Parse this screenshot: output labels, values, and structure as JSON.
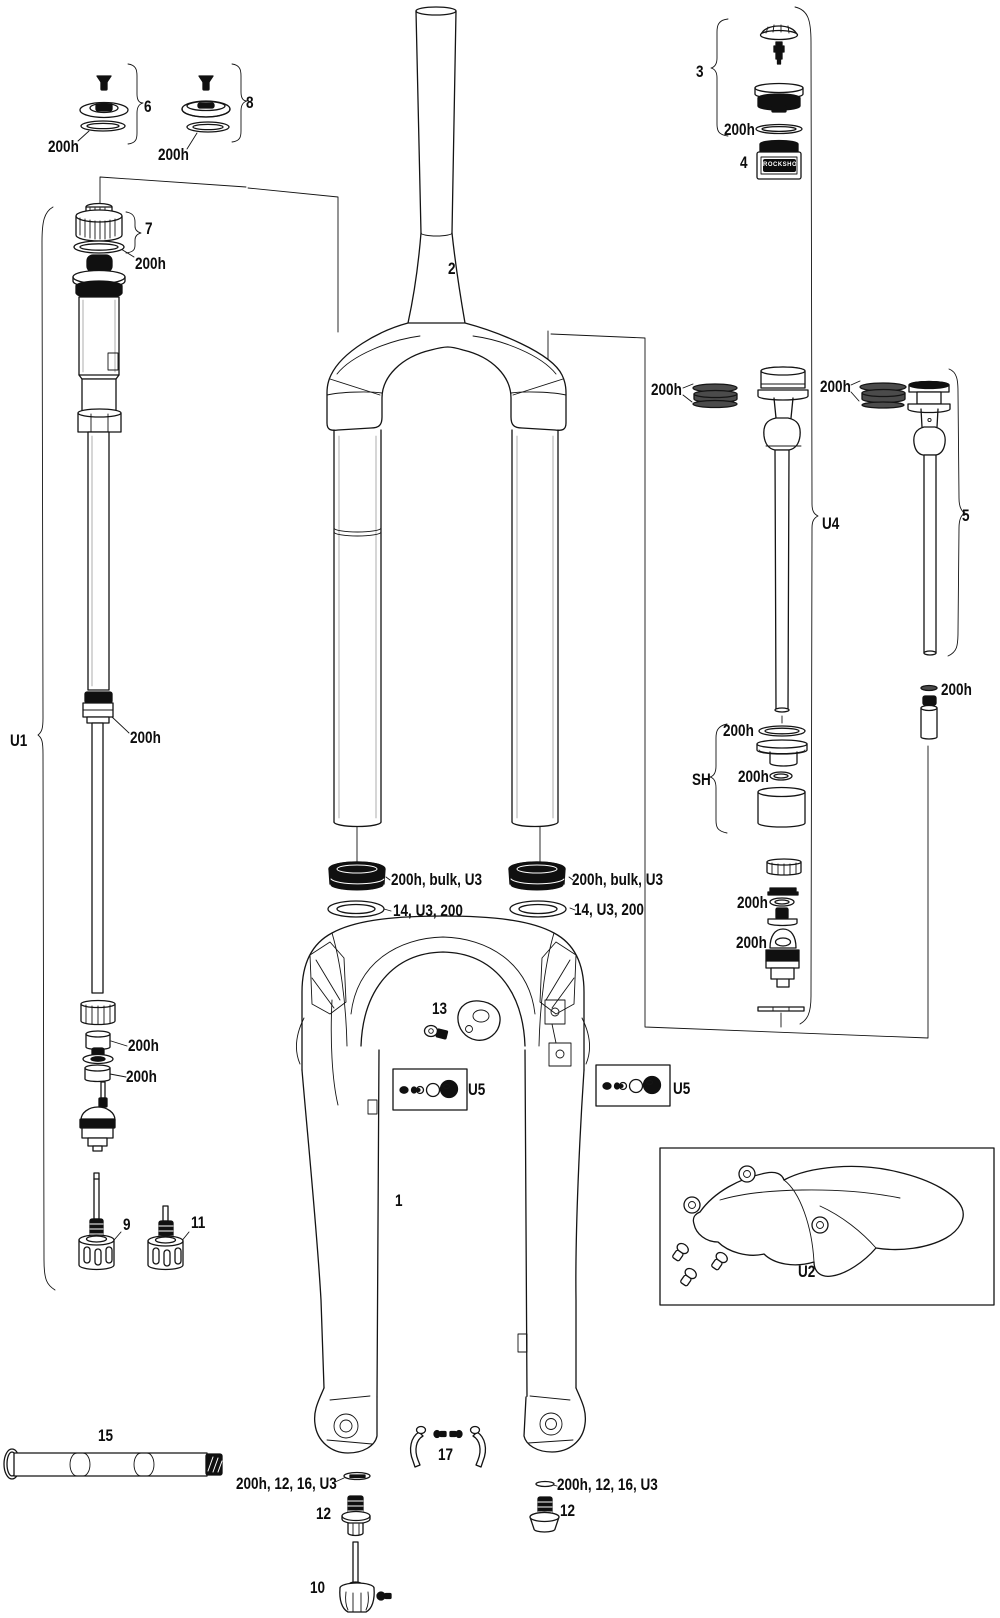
{
  "page": {
    "background": "#ffffff",
    "ink": "#141414"
  },
  "callouts": {
    "c1": "1",
    "c2": "2",
    "c3": "3",
    "c4": "4",
    "c5": "5",
    "c6": "6",
    "c7": "7",
    "c8": "8",
    "c9": "9",
    "c10": "10",
    "c11": "11",
    "c12": "12",
    "c13": "13",
    "c15": "15",
    "c17": "17",
    "u1": "U1",
    "u2": "U2",
    "u4": "U4",
    "u5": "U5",
    "sh": "SH",
    "service": "200h",
    "dust_seal_kit": "200h, bulk, U3",
    "foam_ring": "14, U3, 200",
    "shaft_bolt_seal": "200h, 12, 16, U3",
    "tub_label": "ROCKSHOX"
  }
}
